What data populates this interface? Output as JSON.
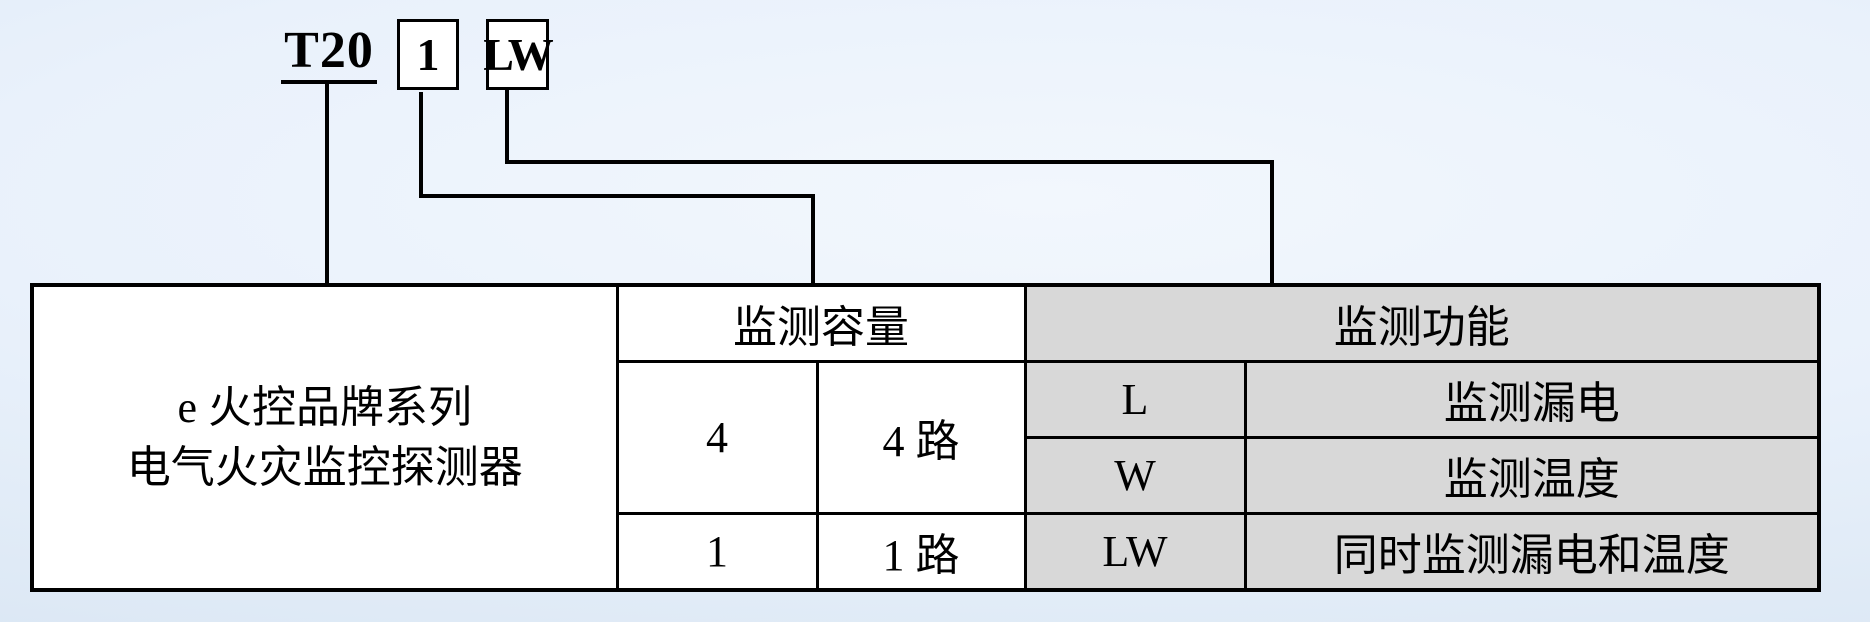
{
  "model_code": {
    "series": "T20",
    "capacity": "1",
    "function": "LW"
  },
  "table": {
    "product_series": {
      "line1": "e 火控品牌系列",
      "line2": "电气火灾监控探测器"
    },
    "capacity_section": {
      "header": "监测容量",
      "rows": [
        {
          "code": "4",
          "desc": "4 路"
        },
        {
          "code": "1",
          "desc": "1 路"
        }
      ]
    },
    "function_section": {
      "header": "监测功能",
      "rows": [
        {
          "code": "L",
          "desc": "监测漏电"
        },
        {
          "code": "W",
          "desc": "监测温度"
        },
        {
          "code": "LW",
          "desc": "同时监测漏电和温度"
        }
      ]
    }
  },
  "colors": {
    "background_center": "#f2f7fd",
    "background_edge": "#d7e4f2",
    "cell_gray": "#d8d8d8",
    "cell_white": "#ffffff",
    "line_black": "#000000"
  }
}
